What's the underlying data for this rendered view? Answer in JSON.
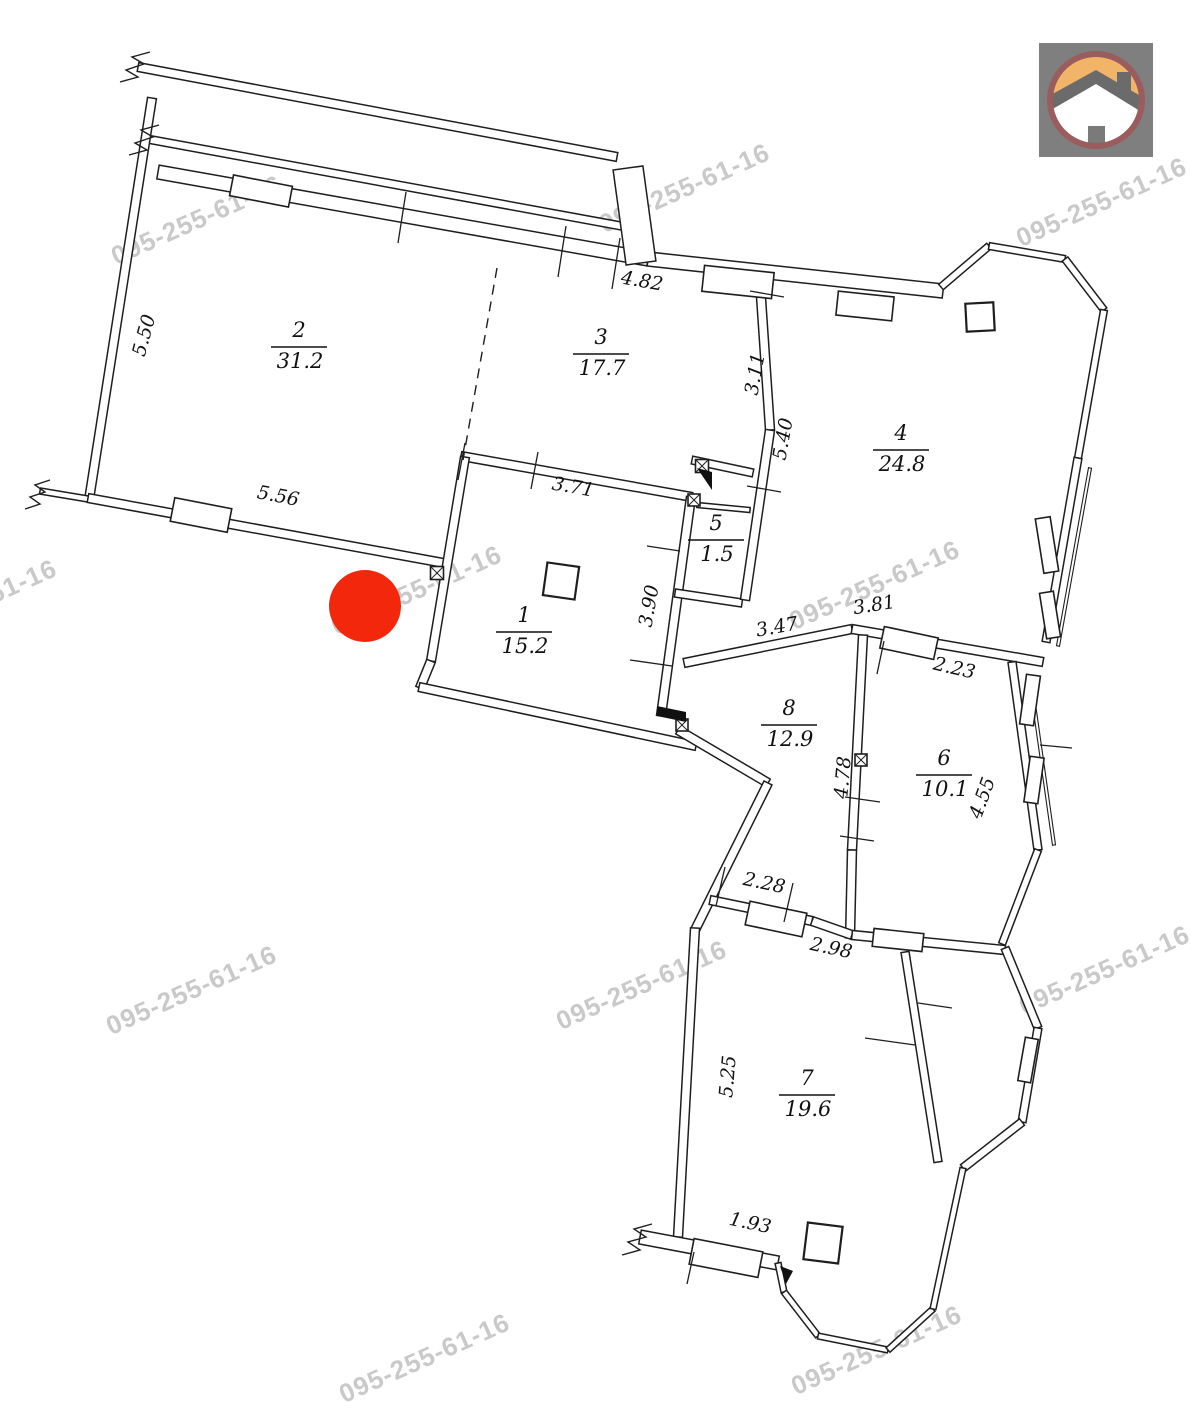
{
  "canvas": {
    "width": 1191,
    "height": 1420,
    "background": "#ffffff"
  },
  "plan_title": "apartment-floor-plan",
  "marker": {
    "x": 365,
    "y": 606,
    "radius": 36,
    "color": "#f3270c"
  },
  "watermark": {
    "text": "095-255-61-16",
    "color": "#c9c9c9",
    "rotation": -24,
    "positions": [
      [
        200,
        228
      ],
      [
        688,
        196
      ],
      [
        1105,
        210
      ],
      [
        -25,
        612
      ],
      [
        420,
        598
      ],
      [
        878,
        593
      ],
      [
        195,
        998
      ],
      [
        645,
        993
      ],
      [
        1108,
        978
      ],
      [
        428,
        1366
      ],
      [
        880,
        1358
      ]
    ]
  },
  "logo": {
    "bg": "#7f7f7f",
    "ring": "#9a5c5c",
    "sky": "#f2b469",
    "house": "#ffffff",
    "roof": "#6b6b6b",
    "door": "#7a7a7a"
  },
  "rooms": [
    {
      "number": "1",
      "area": "15.2",
      "x": 524,
      "y": 630
    },
    {
      "number": "2",
      "area": "31.2",
      "x": 299,
      "y": 345
    },
    {
      "number": "3",
      "area": "17.7",
      "x": 601,
      "y": 352
    },
    {
      "number": "4",
      "area": "24.8",
      "x": 901,
      "y": 448
    },
    {
      "number": "5",
      "area": "1.5",
      "x": 716,
      "y": 538
    },
    {
      "number": "6",
      "area": "10.1",
      "x": 944,
      "y": 773
    },
    {
      "number": "7",
      "area": "19.6",
      "x": 807,
      "y": 1093
    },
    {
      "number": "8",
      "area": "12.9",
      "x": 789,
      "y": 723
    }
  ],
  "dimensions": [
    {
      "text": "5.50",
      "x": 150,
      "y": 337,
      "rot": -75
    },
    {
      "text": "5.56",
      "x": 277,
      "y": 502,
      "rot": 11
    },
    {
      "text": "4.82",
      "x": 641,
      "y": 287,
      "rot": 10
    },
    {
      "text": "3.11",
      "x": 761,
      "y": 375,
      "rot": -80
    },
    {
      "text": "5.40",
      "x": 789,
      "y": 440,
      "rot": -80
    },
    {
      "text": "3.71",
      "x": 572,
      "y": 493,
      "rot": 10
    },
    {
      "text": "3.90",
      "x": 655,
      "y": 607,
      "rot": -80
    },
    {
      "text": "3.47",
      "x": 778,
      "y": 633,
      "rot": -10
    },
    {
      "text": "3.81",
      "x": 875,
      "y": 611,
      "rot": -9
    },
    {
      "text": "2.23",
      "x": 953,
      "y": 674,
      "rot": 13
    },
    {
      "text": "4.78",
      "x": 849,
      "y": 778,
      "rot": -85
    },
    {
      "text": "4.55",
      "x": 988,
      "y": 800,
      "rot": -70
    },
    {
      "text": "2.28",
      "x": 763,
      "y": 889,
      "rot": 12
    },
    {
      "text": "2.98",
      "x": 830,
      "y": 954,
      "rot": 12
    },
    {
      "text": "5.25",
      "x": 734,
      "y": 1077,
      "rot": -85
    },
    {
      "text": "1.93",
      "x": 749,
      "y": 1229,
      "rot": 12
    }
  ]
}
